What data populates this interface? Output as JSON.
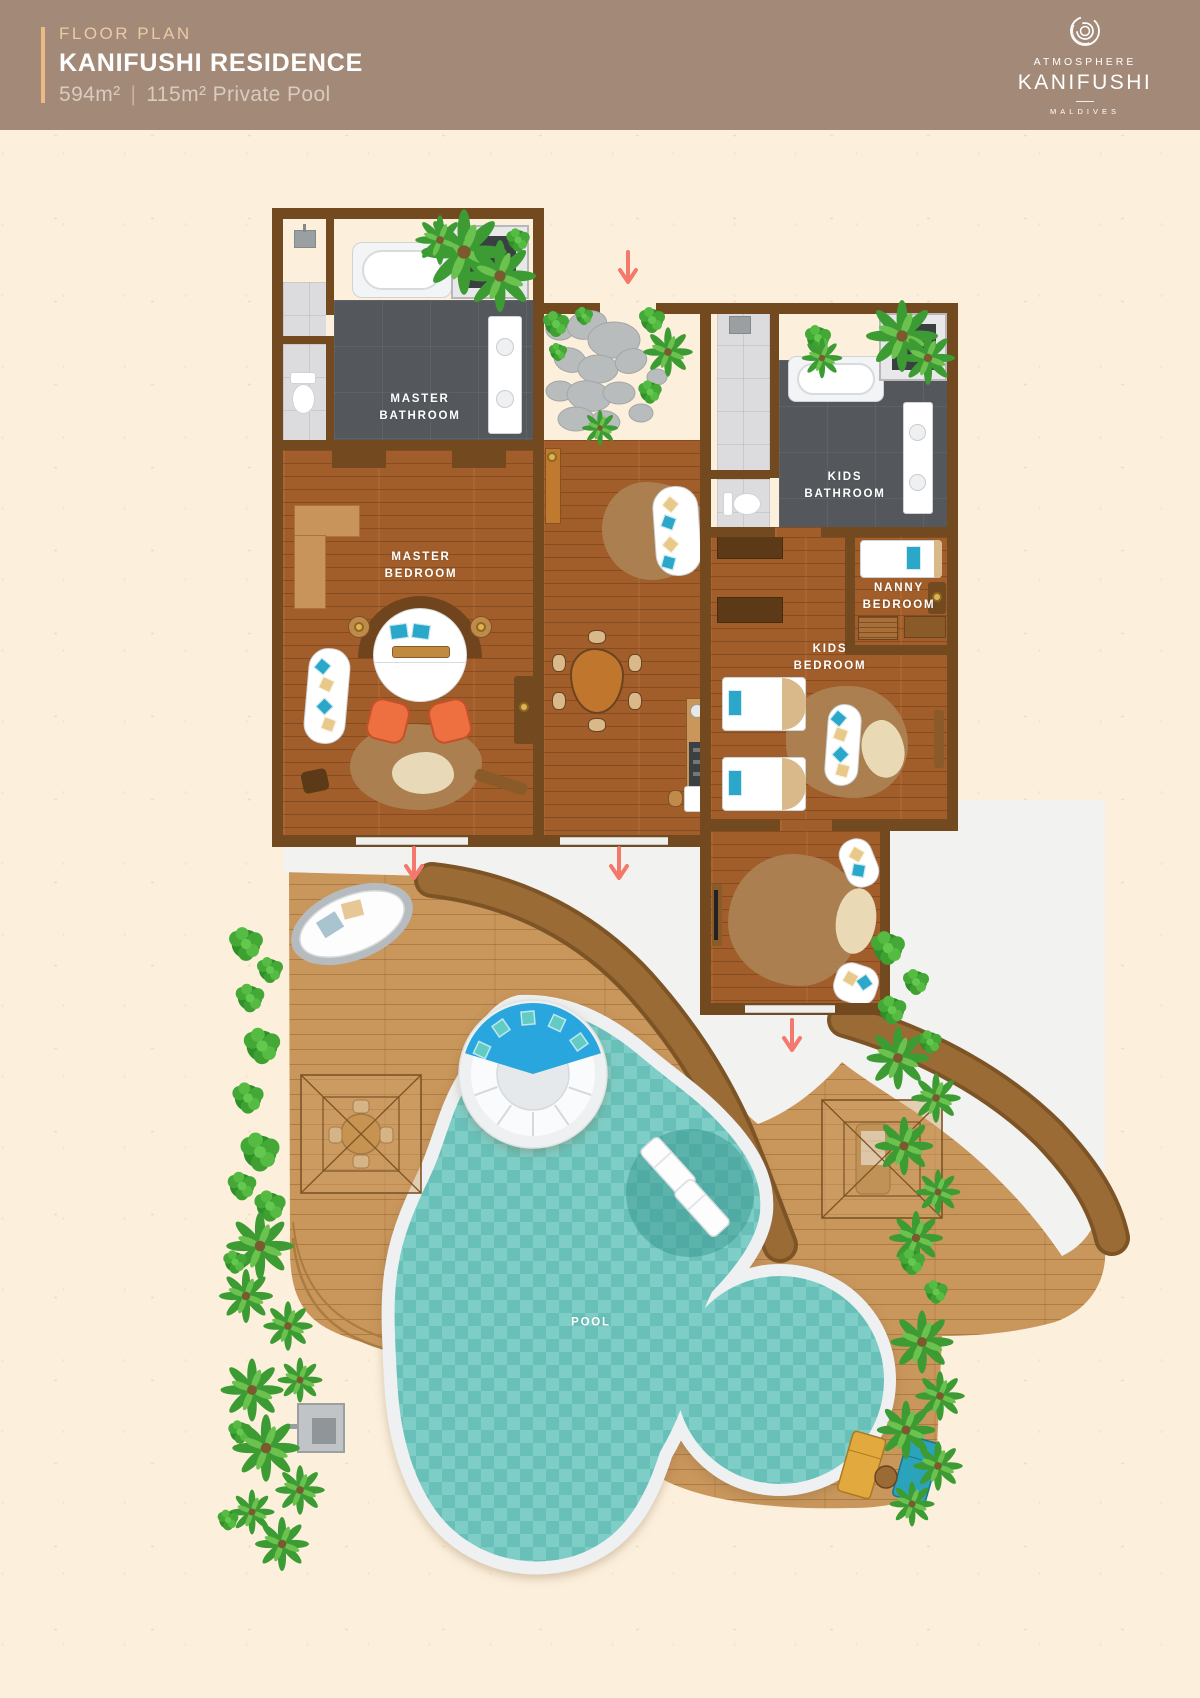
{
  "header": {
    "eyebrow": "FLOOR PLAN",
    "title": "KANIFUSHI RESIDENCE",
    "area_label": "594m²",
    "divider": "|",
    "pool_label": "115m² Private Pool",
    "brand": {
      "line1": "ATMOSPHERE",
      "line2": "KANIFUSHI",
      "line3": "MALDIVES"
    }
  },
  "rooms": {
    "master_bathroom": "MASTER BATHROOM",
    "master_bedroom": "MASTER BEDROOM",
    "kids_bathroom": "KIDS BATHROOM",
    "nanny_bedroom": "NANNY BEDROOM",
    "kids_bedroom": "KIDS BEDROOM",
    "pool": "POOL"
  },
  "colors": {
    "header_background": "#a38977",
    "header_accent_line": "#ecba84",
    "page_background": "#fcf0dd",
    "wall_brown": "#734920",
    "interior_wood": "#a15d2a",
    "bathroom_floor": "#54585c",
    "deck_wood": "#c9965b",
    "deck_band": "#9b6b35",
    "walkway_white": "#f2f2f0",
    "pool_water": "#6fc7bf",
    "entry_arrow": "#f5786c",
    "plant_green": "#44a836"
  }
}
